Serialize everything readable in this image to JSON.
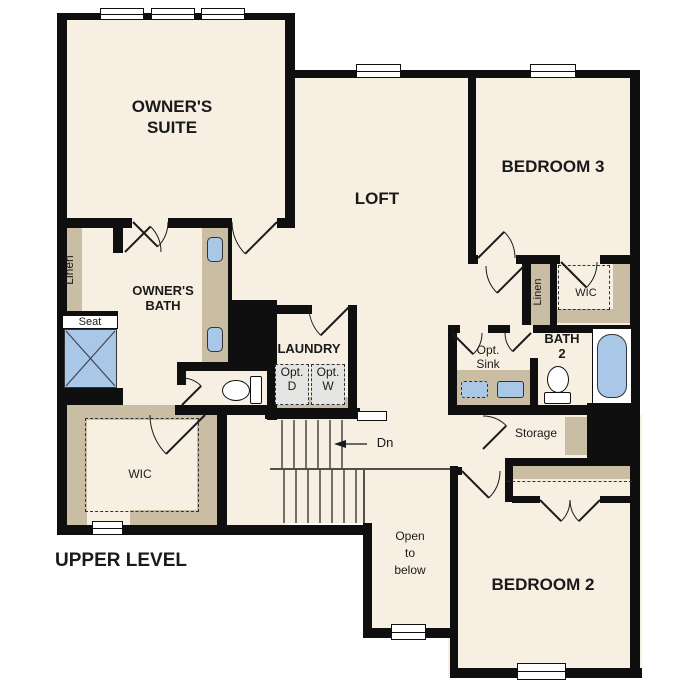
{
  "plan": {
    "title": "UPPER LEVEL",
    "labels": {
      "owners_suite": "OWNER'S\nSUITE",
      "loft": "LOFT",
      "bedroom3": "BEDROOM 3",
      "bedroom2": "BEDROOM 2",
      "owners_bath": "OWNER'S\nBATH",
      "laundry": "LAUNDRY",
      "bath2": "BATH\n2",
      "wic_owner": "WIC",
      "wic_bed3": "WIC",
      "linen_owner": "Linen",
      "linen_bath2": "Linen",
      "seat": "Seat",
      "storage": "Storage",
      "opt_sink": "Opt.\nSink",
      "opt_dryer": "Opt.\nD",
      "opt_washer": "Opt.\nW",
      "down": "Dn",
      "open_to_below": "Open\nto\nbelow"
    },
    "colors": {
      "floor": "#f7efe2",
      "wall": "#0f0f0f",
      "tan": "#c9bda3",
      "blue": "#a9c8e7",
      "gray": "#e4e4e2",
      "line": "#1a1a1a",
      "paper": "#ffffff"
    }
  }
}
